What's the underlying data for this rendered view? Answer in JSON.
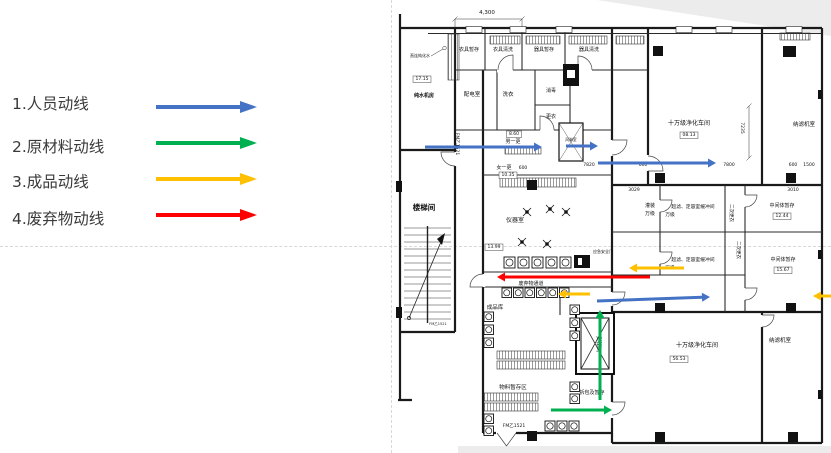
{
  "legend": {
    "items": [
      {
        "label": "1.人员动线",
        "color": "#4472C4"
      },
      {
        "label": "2.原材料动线",
        "color": "#00B050"
      },
      {
        "label": "3.成品动线",
        "color": "#FFC000"
      },
      {
        "label": "4.废弃物动线",
        "color": "#FF0000"
      }
    ]
  },
  "plan": {
    "colors": {
      "blue": "#4472C4",
      "green": "#00B050",
      "yellow": "#FFC000",
      "red": "#FF0000"
    },
    "labels": [
      {
        "text": "4,300",
        "x": 487,
        "y": 14,
        "size": 5.5
      },
      {
        "text": "直连纯化水",
        "x": 420,
        "y": 57,
        "size": 4
      },
      {
        "text": "17.15",
        "x": 422,
        "y": 80,
        "size": 4.5,
        "boxed": true
      },
      {
        "text": "纯水机房",
        "x": 424,
        "y": 97,
        "size": 5,
        "bold": true
      },
      {
        "text": "衣具暂存",
        "x": 469,
        "y": 51,
        "size": 5
      },
      {
        "text": "衣具清洗",
        "x": 503,
        "y": 51,
        "size": 5
      },
      {
        "text": "器具暂存",
        "x": 544,
        "y": 51,
        "size": 5
      },
      {
        "text": "器具清洗",
        "x": 589,
        "y": 51,
        "size": 5
      },
      {
        "text": "配电室",
        "x": 472,
        "y": 96,
        "size": 5.5
      },
      {
        "text": "洗衣",
        "x": 508,
        "y": 96,
        "size": 5.5
      },
      {
        "text": "消毒",
        "x": 551,
        "y": 92,
        "size": 5
      },
      {
        "text": "更衣",
        "x": 551,
        "y": 118,
        "size": 5
      },
      {
        "text": "FM乙1521",
        "x": 456,
        "y": 144,
        "size": 4.5,
        "rotate": 90
      },
      {
        "text": "8.60",
        "x": 514,
        "y": 135,
        "size": 4.5,
        "boxed": true
      },
      {
        "text": "男一更",
        "x": 513,
        "y": 143,
        "size": 5
      },
      {
        "text": "女一更",
        "x": 504,
        "y": 169,
        "size": 5
      },
      {
        "text": "600",
        "x": 523,
        "y": 169,
        "size": 4.5
      },
      {
        "text": "10.35",
        "x": 508,
        "y": 176,
        "size": 4.5,
        "boxed": true
      },
      {
        "text": "风淋室",
        "x": 571,
        "y": 141,
        "size": 3.8
      },
      {
        "text": "楼梯间",
        "x": 424,
        "y": 210,
        "size": 7.5,
        "bold": true
      },
      {
        "text": "FM乙1521",
        "x": 438,
        "y": 325,
        "size": 3.5
      },
      {
        "text": "仪器室",
        "x": 515,
        "y": 222,
        "size": 6
      },
      {
        "text": "13.99",
        "x": 494,
        "y": 248,
        "size": 4.5,
        "boxed": true
      },
      {
        "text": "应急安全门",
        "x": 603,
        "y": 253,
        "size": 4
      },
      {
        "text": "废弃物通道",
        "x": 531,
        "y": 285,
        "size": 5
      },
      {
        "text": "成品库",
        "x": 495,
        "y": 309,
        "size": 5.5
      },
      {
        "text": "货梯间",
        "x": 597,
        "y": 344,
        "size": 5.5,
        "rotate": 90
      },
      {
        "text": "物料暂存区",
        "x": 513,
        "y": 389,
        "size": 5.5
      },
      {
        "text": "拆包及暂存",
        "x": 592,
        "y": 394,
        "size": 5
      },
      {
        "text": "FM乙1521",
        "x": 514,
        "y": 427,
        "size": 4.5
      },
      {
        "text": "十万级净化车间",
        "x": 689,
        "y": 125,
        "size": 6
      },
      {
        "text": "08.13",
        "x": 689,
        "y": 136,
        "size": 4.5,
        "boxed": true
      },
      {
        "text": "7235",
        "x": 741,
        "y": 128,
        "size": 4.5,
        "rotate": 90
      },
      {
        "text": "纳滤机室",
        "x": 804,
        "y": 126,
        "size": 5.5
      },
      {
        "text": "7820",
        "x": 589,
        "y": 166,
        "size": 4.5
      },
      {
        "text": "600",
        "x": 643,
        "y": 166,
        "size": 4.5
      },
      {
        "text": "7800",
        "x": 729,
        "y": 166,
        "size": 4.5
      },
      {
        "text": "600",
        "x": 793,
        "y": 166,
        "size": 4.5
      },
      {
        "text": "1500",
        "x": 809,
        "y": 166,
        "size": 4.5
      },
      {
        "text": "3029",
        "x": 634,
        "y": 191,
        "size": 4.5
      },
      {
        "text": "3010",
        "x": 793,
        "y": 191,
        "size": 4.5
      },
      {
        "text": "灌装",
        "x": 650,
        "y": 207,
        "size": 5
      },
      {
        "text": "万级",
        "x": 650,
        "y": 215,
        "size": 5
      },
      {
        "text": "超滤、定容室缓冲间",
        "x": 693,
        "y": 208,
        "size": 4.8
      },
      {
        "text": "万级",
        "x": 670,
        "y": 216,
        "size": 4.8
      },
      {
        "text": "二次更衣",
        "x": 730,
        "y": 213,
        "size": 4.5,
        "rotate": 90
      },
      {
        "text": "中间体暂存",
        "x": 782,
        "y": 207,
        "size": 5
      },
      {
        "text": "12.44",
        "x": 782,
        "y": 217,
        "size": 4.5,
        "boxed": true
      },
      {
        "text": "超滤、定容室缓冲间",
        "x": 693,
        "y": 261,
        "size": 4.8
      },
      {
        "text": "万级",
        "x": 670,
        "y": 269,
        "size": 4.8
      },
      {
        "text": "二次更衣",
        "x": 737,
        "y": 250,
        "size": 4.5,
        "rotate": 90
      },
      {
        "text": "中间体暂存",
        "x": 783,
        "y": 261,
        "size": 5
      },
      {
        "text": "15.67",
        "x": 783,
        "y": 271,
        "size": 4.5,
        "boxed": true
      },
      {
        "text": "十万级净化车间",
        "x": 697,
        "y": 347,
        "size": 6
      },
      {
        "text": "56.53",
        "x": 679,
        "y": 360,
        "size": 4.5,
        "boxed": true
      },
      {
        "text": "纳滤机室",
        "x": 780,
        "y": 342,
        "size": 5.5
      }
    ],
    "arrows": [
      {
        "x1": 425,
        "y1": 147,
        "x2": 542,
        "y2": 147,
        "color": "blue"
      },
      {
        "x1": 566,
        "y1": 146,
        "x2": 598,
        "y2": 146,
        "color": "blue"
      },
      {
        "x1": 598,
        "y1": 163,
        "x2": 716,
        "y2": 163,
        "color": "blue"
      },
      {
        "x1": 597,
        "y1": 301,
        "x2": 710,
        "y2": 297,
        "color": "blue"
      },
      {
        "x1": 600,
        "y1": 400,
        "x2": 600,
        "y2": 310,
        "color": "green"
      },
      {
        "x1": 551,
        "y1": 410,
        "x2": 612,
        "y2": 410,
        "color": "green"
      },
      {
        "x1": 590,
        "y1": 294,
        "x2": 558,
        "y2": 294,
        "color": "yellow"
      },
      {
        "x1": 684,
        "y1": 268,
        "x2": 629,
        "y2": 268,
        "color": "yellow"
      },
      {
        "x1": 839,
        "y1": 296,
        "x2": 813,
        "y2": 296,
        "color": "yellow"
      },
      {
        "x1": 650,
        "y1": 277,
        "x2": 497,
        "y2": 277,
        "color": "red"
      }
    ]
  }
}
